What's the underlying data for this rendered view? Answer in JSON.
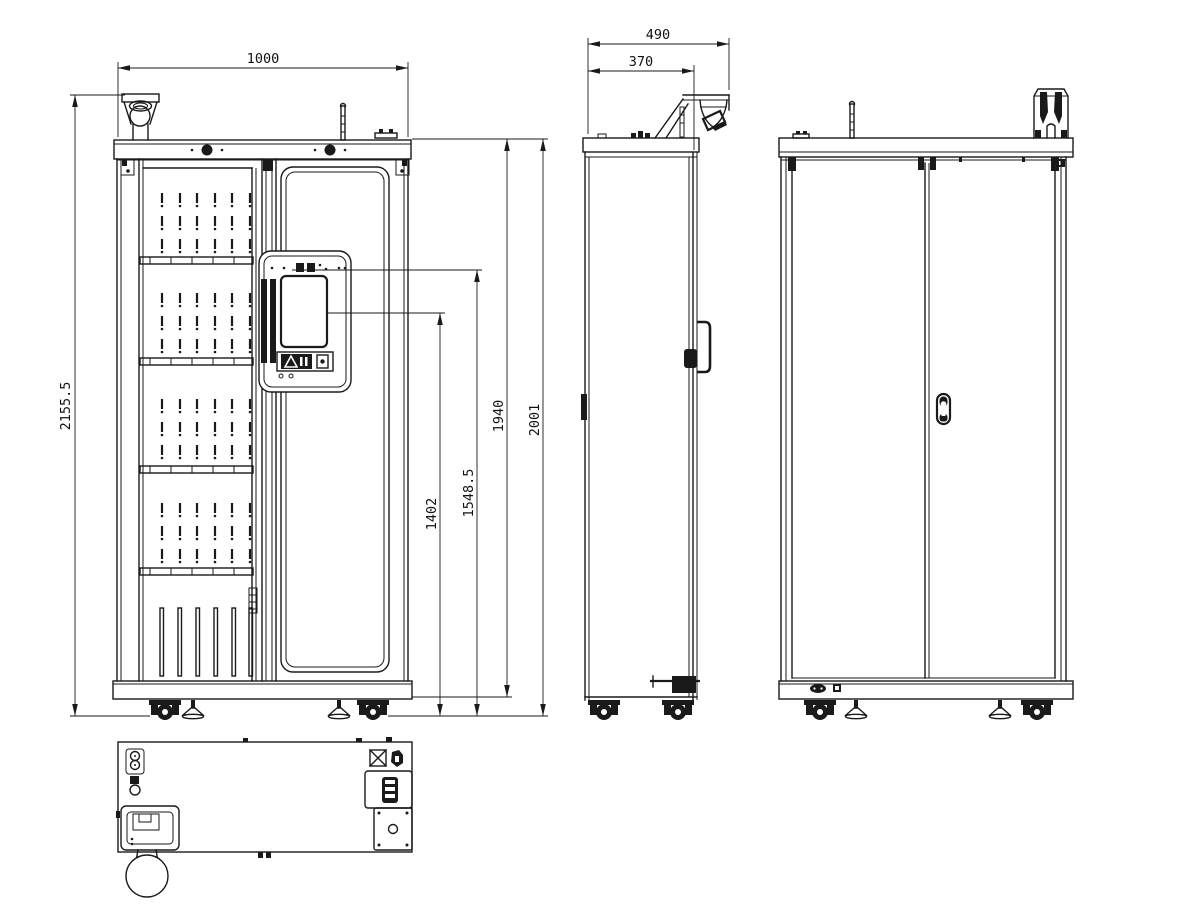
{
  "dimensions": {
    "cabinet_width": "1000",
    "total_height_with_camera": "2155.5",
    "display_lower_height": "1402",
    "display_upper_height": "1548.5",
    "body_height": "1940",
    "cabinet_height": "2001",
    "overall_depth": "490",
    "body_depth": "370"
  },
  "colors": {
    "line": "#1a1a1a",
    "background": "#ffffff"
  }
}
